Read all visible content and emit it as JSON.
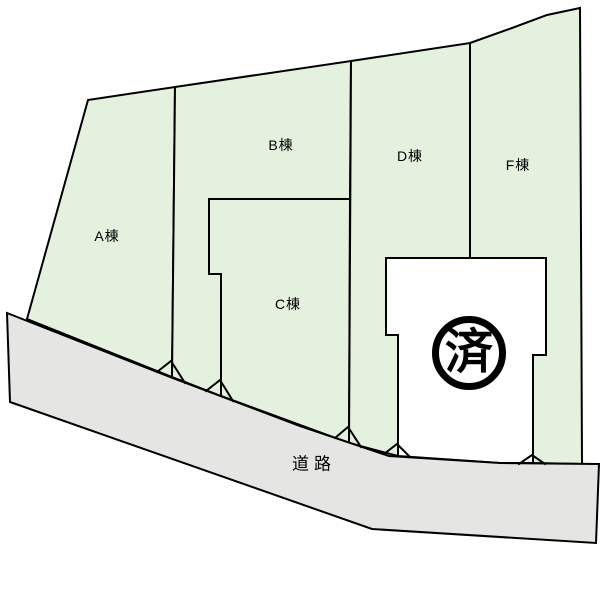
{
  "lots": {
    "a": {
      "label": "A棟"
    },
    "b": {
      "label": "B棟"
    },
    "c": {
      "label": "C棟"
    },
    "d": {
      "label": "D棟"
    },
    "f": {
      "label": "F棟"
    }
  },
  "sold_lot": {
    "stamp": "済"
  },
  "road": {
    "label": "道路"
  },
  "colors": {
    "lot_fill": "#e3f1de",
    "sold_fill": "#ffffff",
    "road_fill": "#e5e5e3",
    "line": "#000000"
  }
}
